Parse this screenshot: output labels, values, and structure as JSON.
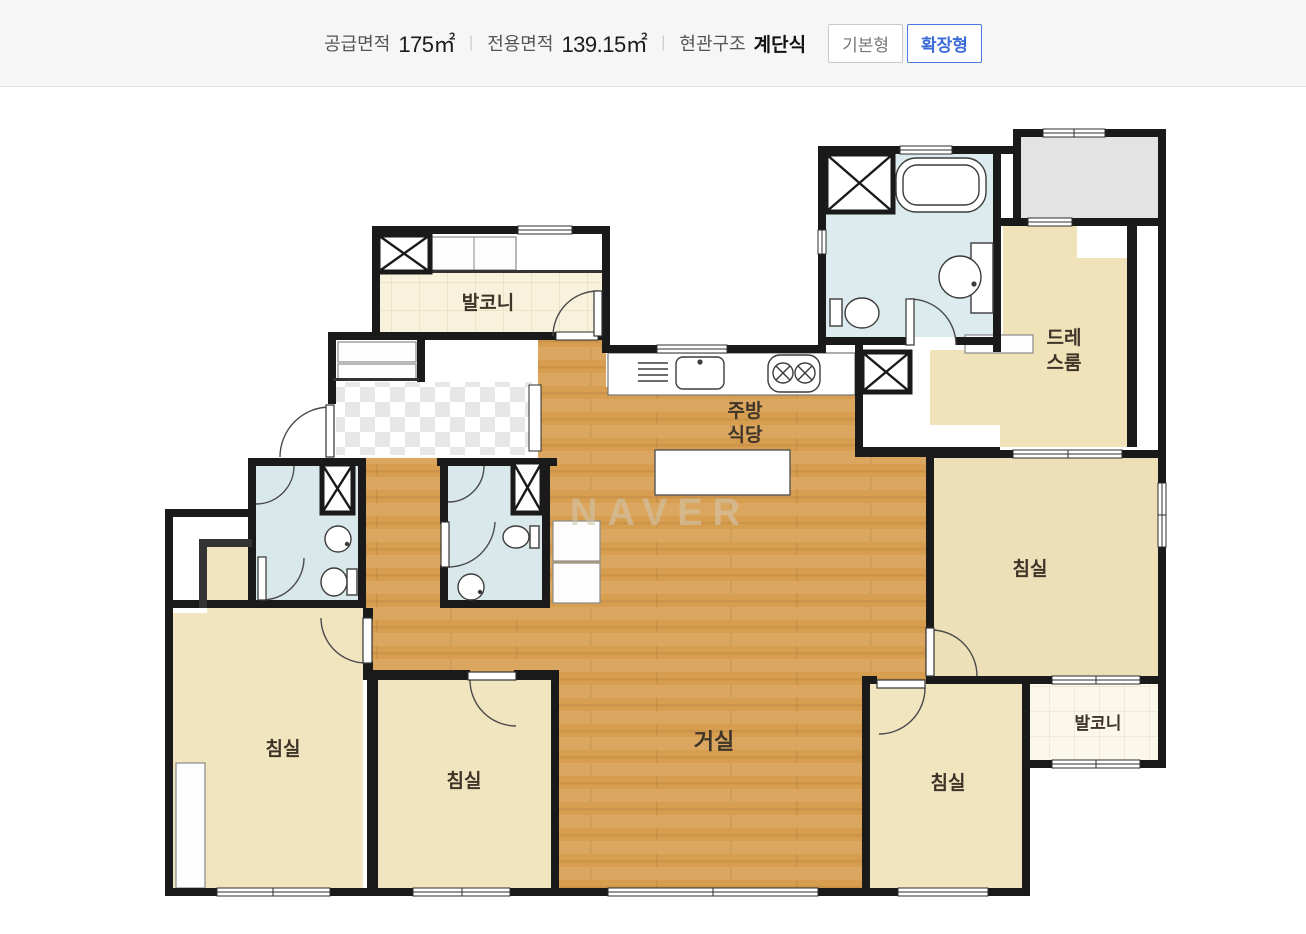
{
  "header": {
    "supply_label": "공급면적",
    "supply_value": "175㎡",
    "exclusive_label": "전용면적",
    "exclusive_value": "139.15㎡",
    "entrance_label": "현관구조",
    "entrance_value": "계단식",
    "separator": "|",
    "buttons": [
      {
        "label": "기본형",
        "active": false
      },
      {
        "label": "확장형",
        "active": true
      }
    ]
  },
  "floorplan": {
    "watermark": "NAVER",
    "labels": {
      "balcony_top": "발코니",
      "balcony_right": "발코니",
      "kitchen_dining": [
        "주방",
        "식당"
      ],
      "dress_room": [
        "드레",
        "스룸"
      ],
      "living": "거실",
      "bedroom": "침실"
    },
    "colors": {
      "wall": "#1a1a1a",
      "wood_floor": "#d79e50",
      "room_cream": "#f1e5c0",
      "bath_blue": "#d9e8eb",
      "tile_cream": "#f8f1dc",
      "duct_gray": "#e3e3e3",
      "accent_blue": "#3a6bd8"
    }
  }
}
